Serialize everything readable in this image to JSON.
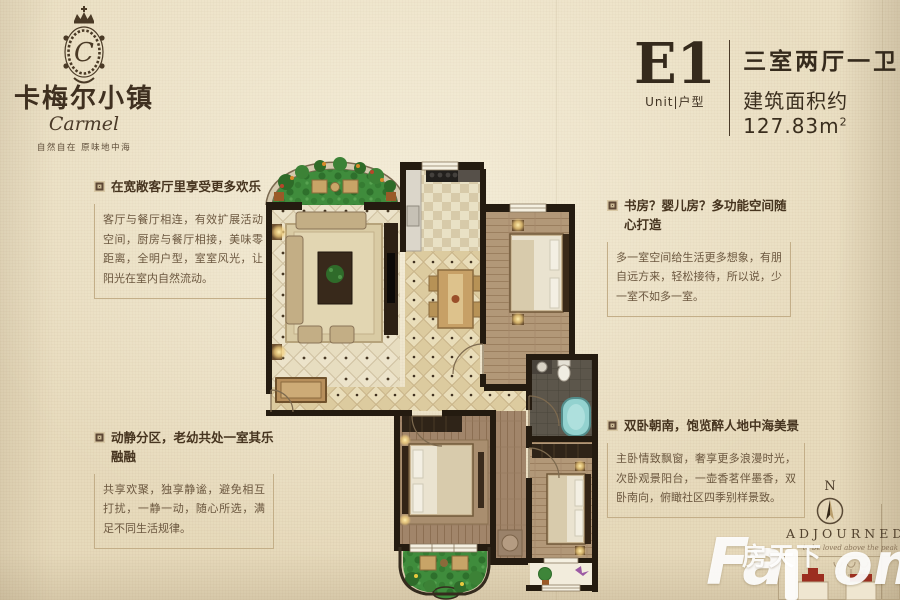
{
  "logo": {
    "title": "卡梅尔小镇",
    "monogram": "C",
    "script": "Carmel",
    "tagline": "自然自在 原味地中海"
  },
  "unit": {
    "code": "E1",
    "sub": "Unit|户型",
    "layout": "三室两厅一卫",
    "area_prefix": "建筑面积约",
    "area_value": "127.83",
    "area_unit": "m",
    "area_sup": "2"
  },
  "features": [
    {
      "id": "living",
      "title": "在宽敞客厅里享受更多欢乐",
      "body": "客厅与餐厅相连，有效扩展活动空间，厨房与餐厅相接，美味零距离，全明户型，室室风光，让阳光在室内自然流动。"
    },
    {
      "id": "zoning",
      "title": "动静分区，老幼共处一室其乐融融",
      "body": "共享欢聚，独享静谧，避免相互打扰，一静一动，随心所选，满足不同生活规律。"
    },
    {
      "id": "flexroom",
      "title": "书房？婴儿房？多功能空间随心打造",
      "body": "多一室空间给生活更多想象，有朋自远方来，轻松接待，所以说，少一室不如多一室。"
    },
    {
      "id": "bedrooms",
      "title": "双卧朝南，饱览醉人地中海美景",
      "body": "主卧情致飘窗，奢享更多浪漫时光，次卧观景阳台，一壶香茗伴墨香，双卧南向，俯瞰社区四季别样景致。"
    }
  ],
  "compass": {
    "label": "N"
  },
  "signature": {
    "brand": "ADJOURNED",
    "slogan": "to be loved above the peak"
  },
  "watermark": {
    "left": "Fa",
    "cn": "房天下",
    "right": "om"
  },
  "colors": {
    "background": "#eadfc2",
    "ink": "#43331f",
    "wall": "#241b10",
    "grass": "#3f8c3c",
    "tile": "#ece3ca",
    "wood": "#a1856a",
    "accent_red": "#9c2e20",
    "watermark": "#ffffff"
  }
}
